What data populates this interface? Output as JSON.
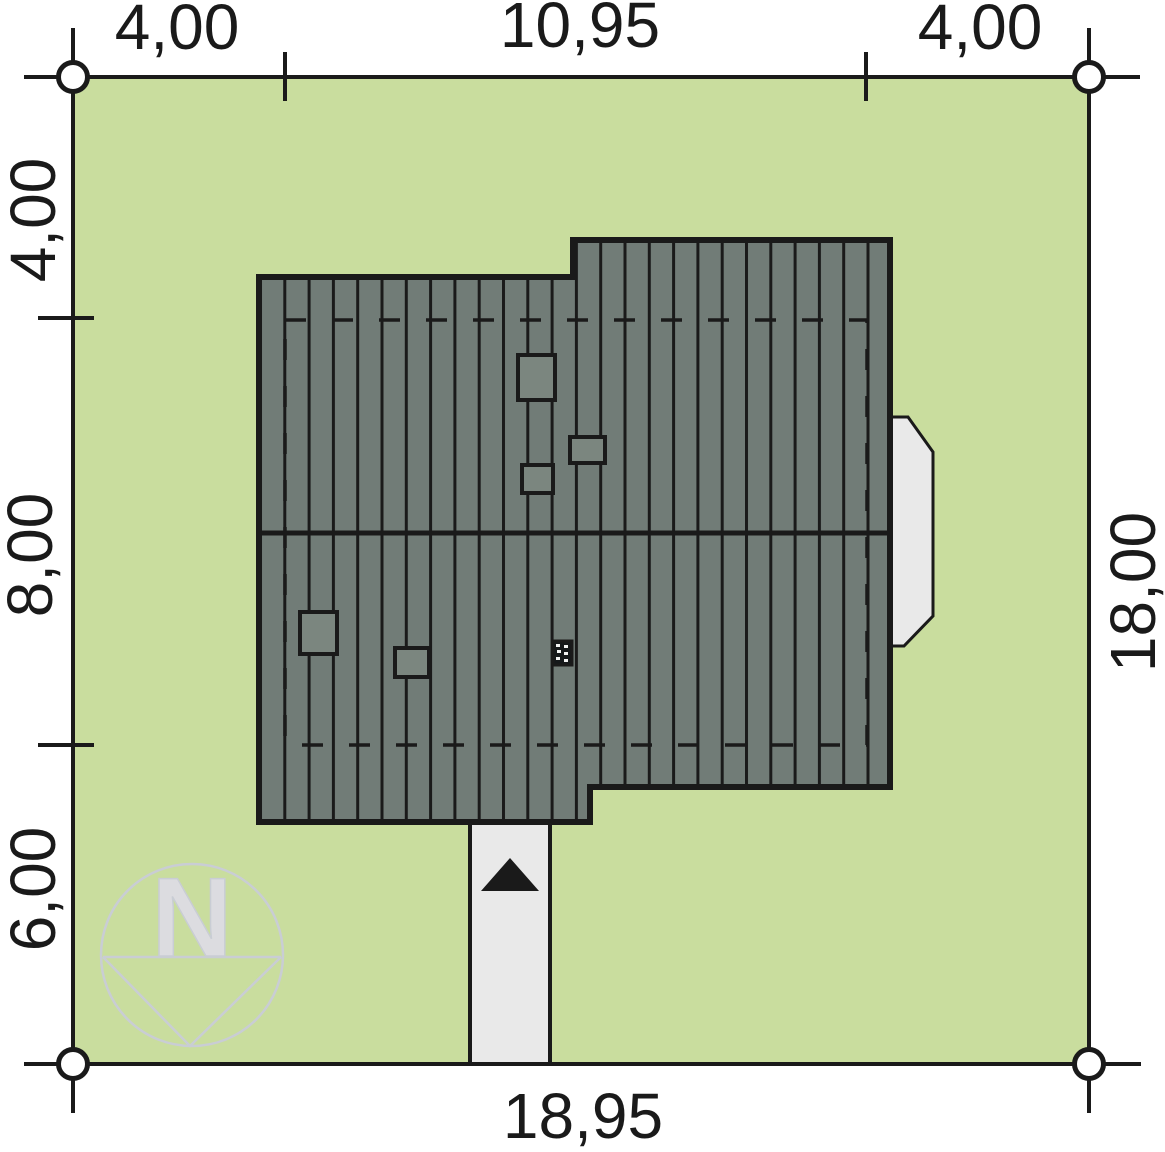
{
  "drawing": {
    "type_label": "site-plan",
    "plot": {
      "width_label": "18,95",
      "height_label": "18,00"
    }
  },
  "dimensions": {
    "top": [
      "4,00",
      "10,95",
      "4,00"
    ],
    "left": [
      "4,00",
      "8,00",
      "6,00"
    ],
    "right": [
      "18,00"
    ],
    "bottom": [
      "18,95"
    ]
  },
  "compass": {
    "letter": "N"
  },
  "colors": {
    "plot_green": "#c9dd9e",
    "roof_gray": "#717c77",
    "roof_gray_light": "#7b867f",
    "paving_gray": "#e9e9e9",
    "line": "#1a1a1a",
    "compass_gray": "#c9cdd4",
    "compass_letter_gray": "#dcdce0"
  }
}
